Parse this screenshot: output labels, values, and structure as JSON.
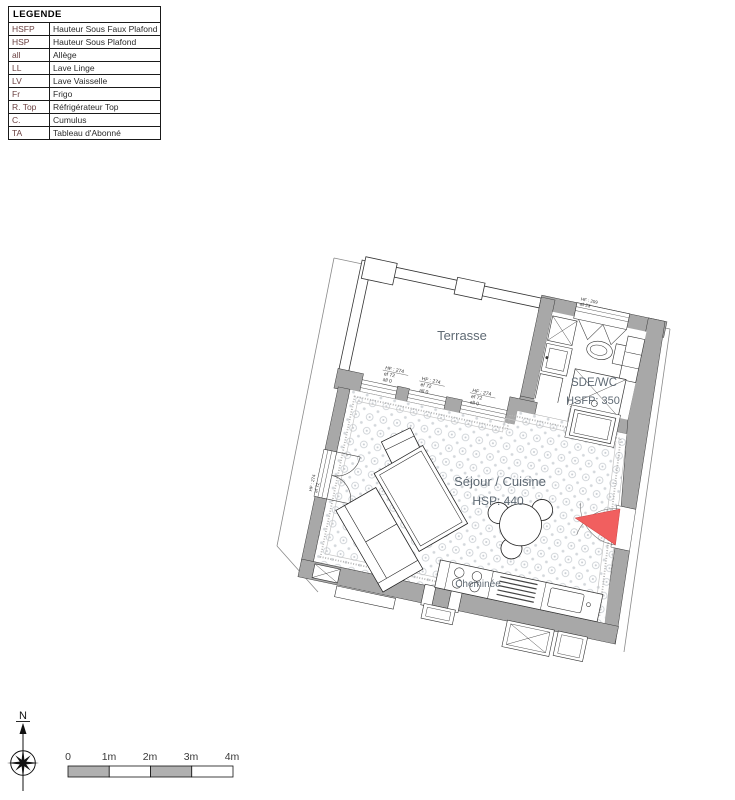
{
  "legend": {
    "title": "LEGENDE",
    "rows": [
      [
        "HSFP",
        "Hauteur Sous Faux Plafond"
      ],
      [
        "HSP",
        "Hauteur Sous Plafond"
      ],
      [
        "all",
        "Allège"
      ],
      [
        "LL",
        "Lave Linge"
      ],
      [
        "LV",
        "Lave Vaisselle"
      ],
      [
        "Fr",
        "Frigo"
      ],
      [
        "R. Top",
        "Réfrigérateur Top"
      ],
      [
        "C.",
        "Cumulus"
      ],
      [
        "TA",
        "Tableau d'Abonné"
      ]
    ]
  },
  "plan": {
    "rooms": {
      "terrasse": {
        "name": "Terrasse"
      },
      "sde": {
        "name": "SDE/WC",
        "ceiling": "HSFP: 350"
      },
      "sejour": {
        "name": "Séjour / Cuisine",
        "ceiling": "HSP: 440"
      }
    },
    "chimney_label": "Cheminée",
    "window_annotation": {
      "l1": "HF : 274",
      "l2": "ef 72",
      "l3": "all 0"
    },
    "sde_window_annotation": {
      "l1": "HF : 209",
      "l2": "all 23"
    },
    "left_window_annotation": {
      "l1": "HF : 274",
      "l2": "ef 72"
    }
  },
  "compass": {
    "north_label": "N"
  },
  "scale_bar": {
    "ticks": [
      "0",
      "1m",
      "2m",
      "3m",
      "4m"
    ]
  },
  "colors": {
    "wall": "#a8a8a8",
    "entrance_marker": "#f15f5f",
    "room_label": "#5f6a74",
    "legend_abbr": "#6b4141"
  }
}
